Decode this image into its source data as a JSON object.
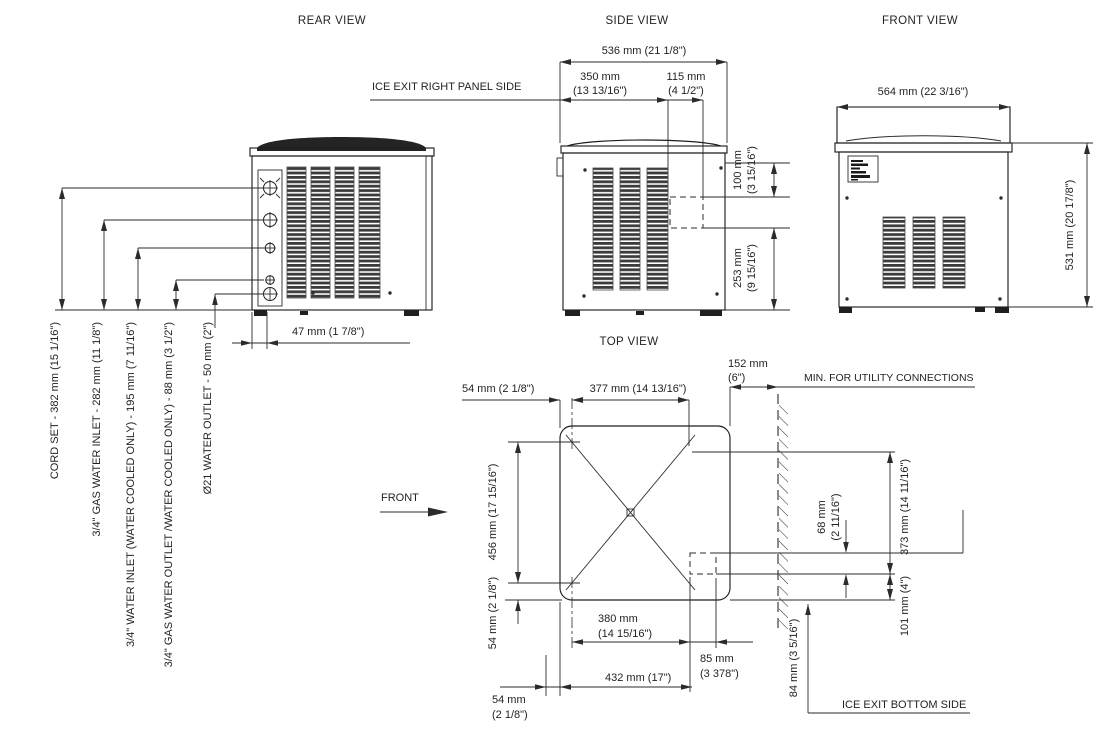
{
  "drawing": {
    "rear": {
      "title": "REAR VIEW",
      "dim_47": "47 mm (1 7/8\")",
      "conn_labels": [
        "CORD SET -  382 mm (15 1/16\")",
        "3/4\" GAS WATER INLET -  282 mm (11 1/8\")",
        "3/4\" WATER INLET (WATER COOLED ONLY)  - 195 mm (7 11/16\")",
        "3/4\" GAS WATER OUTLET /WATER COOLED ONLY) - 88 mm (3 1/2\")",
        "Ø21 WATER OUTLET - 50 mm (2\")"
      ]
    },
    "side": {
      "title": "SIDE VIEW",
      "dim_536": "536 mm (21 1/8\")",
      "dim_350_l1": "350 mm",
      "dim_350_l2": "(13 13/16\")",
      "dim_115_l1": "115 mm",
      "dim_115_l2": "(4 1/2\")",
      "ice_exit_label": "ICE EXIT  RIGHT PANEL SIDE",
      "dim_100_l1": "100 mm",
      "dim_100_l2": "(3 15/16\")",
      "dim_253_l1": "253 mm",
      "dim_253_l2": "(9 15/16\")"
    },
    "front": {
      "title": "FRONT VIEW",
      "dim_564": "564 mm (22 3/16\")",
      "dim_531": "531 mm  (20 17/8\")"
    },
    "top": {
      "title": "TOP VIEW",
      "front_label": "FRONT",
      "dim_54_top": "54 mm  (2 1/8\")",
      "dim_377": "377 mm  (14 13/16\")",
      "dim_152_l1": "152 mm",
      "dim_152_l2": "(6\")",
      "min_utility": "MIN. FOR UTILITY CONNECTIONS",
      "dim_456": "456 mm (17 15/16\")",
      "dim_54_left": "54 mm (2 1/8\")",
      "dim_380_l1": "380 mm",
      "dim_380_l2": "(14 15/16\")",
      "dim_432": "432 mm  (17\")",
      "dim_54_bot_l1": "54 mm",
      "dim_54_bot_l2": "(2 1/8\")",
      "dim_85_l1": "85 mm",
      "dim_85_l2": "(3 378\")",
      "dim_68_l1": "68 mm",
      "dim_68_l2": "(2 11/16\")",
      "dim_373": "373 mm (14 11/16\")",
      "dim_101": "101 mm (4\")",
      "dim_84": "84 mm  (3 5/16\")",
      "ice_exit_bottom": "ICE EXIT  BOTTOM SIDE"
    }
  }
}
